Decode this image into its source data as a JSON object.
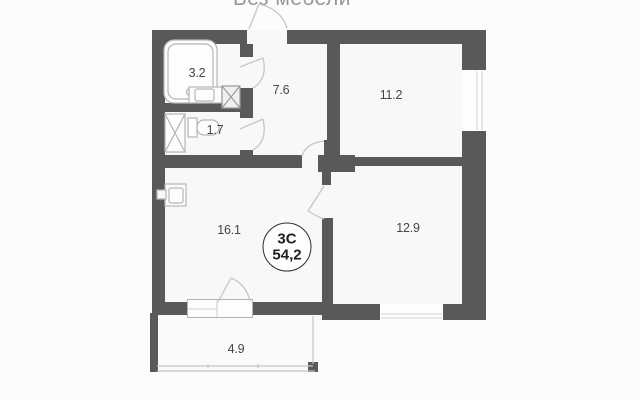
{
  "title": "Без мебели",
  "badge": {
    "type": "3C",
    "area": "54,2"
  },
  "rooms": [
    {
      "id": "bathroom",
      "area": "3.2"
    },
    {
      "id": "wc",
      "area": "1.7"
    },
    {
      "id": "hallway",
      "area": "7.6"
    },
    {
      "id": "bedroom",
      "area": "11.2"
    },
    {
      "id": "kitchen-living",
      "area": "16.1"
    },
    {
      "id": "room",
      "area": "12.9"
    },
    {
      "id": "balcony",
      "area": "4.9"
    }
  ],
  "icons": [
    "bathtub-icon",
    "bathroom-sink-icon",
    "vent-shaft-icon",
    "washing-machine-icon",
    "toilet-icon",
    "kitchen-sink-icon",
    "door-swing-icon",
    "window-icon"
  ],
  "colors": {
    "wall": "#595959",
    "floor": "#f8f8f8",
    "door_line": "#c6c6c6",
    "fixture_line": "#b5b5b5",
    "label_text": "#454545",
    "badge_border": "#2d2d2d",
    "title_text": "#95989a",
    "background": "#fcfcfc"
  }
}
